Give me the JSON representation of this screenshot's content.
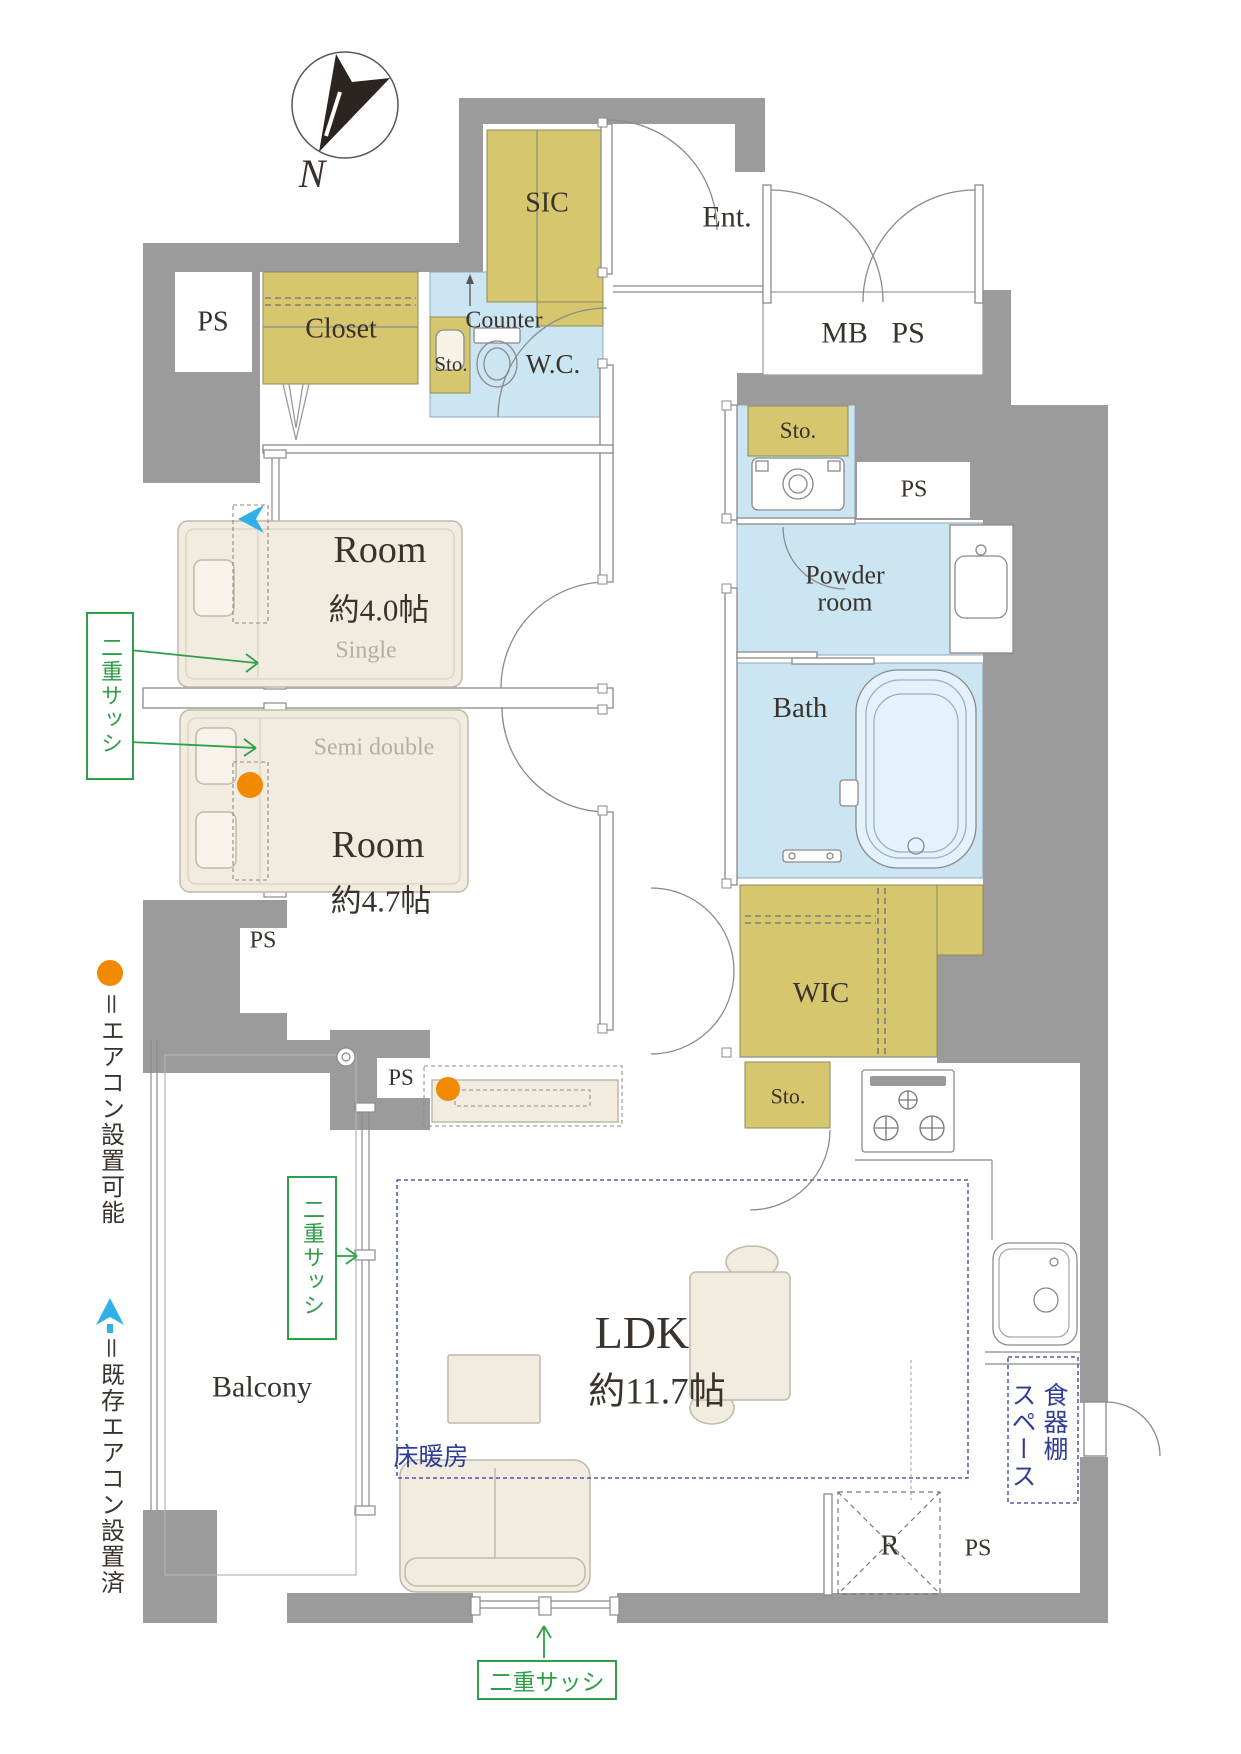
{
  "compass": {
    "label": "N"
  },
  "legend": {
    "aircon_possible": "＝エアコン設置可能",
    "aircon_existing": "＝既存エアコン設置済"
  },
  "labels": {
    "sic": "SIC",
    "ent": "Ent.",
    "mb_ps": "MB PS",
    "ps_nw": "PS",
    "closet": "Closet",
    "counter": "Counter",
    "wc_storage": "Sto.",
    "wc": "W.C.",
    "laundry_storage": "Sto.",
    "ps_laundry": "PS",
    "powder_room": "Powder room",
    "bath": "Bath",
    "wic": "WIC",
    "kitchen_storage": "Sto.",
    "ps_room2": "PS",
    "ps_balcony": "PS",
    "balcony": "Balcony",
    "floor_heating": "床暖房",
    "cupboard_line1": "食器棚",
    "cupboard_line2": "スペース",
    "fridge": "R",
    "ps_se": "PS",
    "double_sash_left": "二重サッシ",
    "double_sash_balcony": "二重サッシ",
    "double_sash_bottom": "二重サッシ"
  },
  "rooms": {
    "room1": {
      "name": "Room",
      "size": "約4.0帖",
      "bed": "Single"
    },
    "room2": {
      "name": "Room",
      "size": "約4.7帖",
      "bed": "Semi double"
    },
    "ldk": {
      "name": "LDK",
      "size": "約11.7帖"
    }
  },
  "icons": {
    "compass_needle": "north-arrow",
    "aircon_possible_dot": "orange-circle",
    "aircon_existing_mark": "cyan-spade-arrow"
  },
  "colors": {
    "wall_gray": "#9b9b9b",
    "storage_yellow": "#d6c76e",
    "wet_area_blue": "#cbe5f3",
    "furniture_beige": "#f1ecdf",
    "accent_green": "#2f9e49",
    "accent_blue": "#2f3d96",
    "aircon_orange": "#f18a00",
    "aircon_cyan": "#31b0e8"
  }
}
